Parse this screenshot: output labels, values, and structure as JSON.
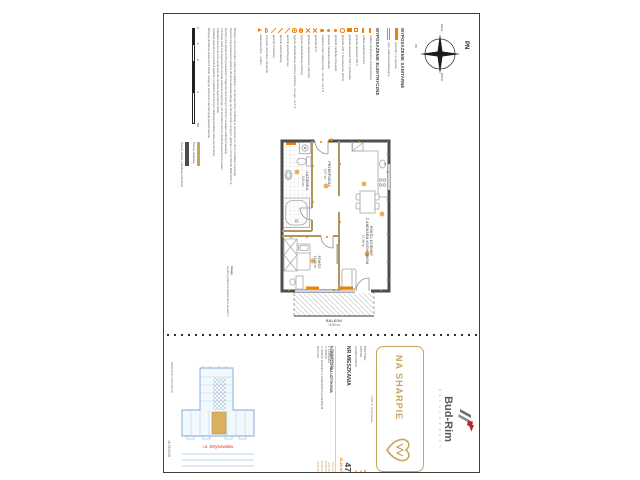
{
  "meta": {
    "date": "16.09.2025",
    "website": "www.bud-rim.com.pl"
  },
  "colors": {
    "accent_orange": "#EE8109",
    "wall_dark": "#4D4D4D",
    "wall_partition_gold": "#B2955C",
    "keyplan_blue": "#7DA7D9",
    "logo_gold": "#C9A45C",
    "brand_red": "#C02428",
    "street_red": "#D03020"
  },
  "compass": {
    "n": "PN",
    "s": "PD",
    "e": "WSCH",
    "w": "ZACH"
  },
  "brand": {
    "name": "Bud-Rim",
    "tagline": "D E V E L O P M E N T"
  },
  "investment": {
    "logo_text": "NA SHARPIE",
    "address": "Łódź ul. Strykowska"
  },
  "keyplan": {
    "street": "ul. Strykowska"
  },
  "scalebar": {
    "t0": "0",
    "t1": "1",
    "t2": "2",
    "t4": "4",
    "t6": "6m"
  },
  "walls_legend": {
    "partition": "Ściany działowe",
    "bearing": "Ściany nośne i obudowy kominów"
  },
  "sanitary": {
    "title": "WYPOSAŻENIE SANITARNE",
    "items": [
      {
        "icon": "radiator-bar",
        "label": "grzejnik c.o. płytowy"
      },
      {
        "icon": "riser-double-bar",
        "label": "pion wodno-kanalizacyjny"
      }
    ]
  },
  "electrical": {
    "title": "WYPOSAŻENIE ELEKTRYCZNE",
    "items": [
      {
        "icon": "bar",
        "label": "tablica elektryczna mieszkaniowa"
      },
      {
        "icon": "bar",
        "label": "tablica teletechniczna"
      },
      {
        "icon": "square",
        "label": "gniazdo wtykowe 230 V"
      },
      {
        "icon": "square-filled",
        "label": "gniazdo wtykowe 230 V podwójne"
      },
      {
        "icon": "ring",
        "label": "gniazdo 230 V hermetyczne (IP44)"
      },
      {
        "icon": "dot",
        "label": "gniazdo zasilania zmywarki"
      },
      {
        "icon": "dot",
        "label": "gniazdo zasilania lodówki"
      },
      {
        "icon": "dot",
        "label": "zasilanie płyty elektrycznej - we wn. +0,4 m"
      },
      {
        "icon": "x",
        "label": "gniazdo RTV"
      },
      {
        "icon": "x",
        "label": "gniazdo teletechniczne (internet)"
      },
      {
        "icon": "lamp",
        "label": "wypust oświetleniowy sufitowy"
      },
      {
        "icon": "lamp",
        "label": "wypust oświetleniowy ścienny (kinkiet) - na wys. +2,1 m"
      },
      {
        "icon": "switch",
        "label": "łącznik jednobiegunowy"
      },
      {
        "icon": "switch",
        "label": "łącznik świecznikowy"
      },
      {
        "icon": "switch",
        "label": "łącznik schodowy"
      },
      {
        "icon": "bell",
        "label": "przycisk dzwonka / dzwonek"
      },
      {
        "icon": "triangle",
        "label": "wideodomofon - unifon"
      }
    ]
  },
  "unit": {
    "number_label": "NR MIESZKANIA",
    "number": "47",
    "building_label": "BUDYNEK",
    "building": "B",
    "floor_label": "PIĘTRO",
    "floor": "2",
    "rooms_label": "LICZBA POKOI",
    "rooms_count": "2",
    "area_label": "POWIERZCHNIA UŻYTKOWA",
    "area": "51,26 m²",
    "room_rows": [
      {
        "no": "1.",
        "name": "PRZEDPOKÓJ",
        "area": "5,97 m²"
      },
      {
        "no": "2.",
        "name": "ŁAZIENKA",
        "area": "3,95 m²"
      },
      {
        "no": "3.",
        "name": "POKÓJ",
        "area": "13,96 m²"
      },
      {
        "no": "4.",
        "name": "POKÓJ DZIENNY Z ANEKSEM KUCHENNYM",
        "area": "27,38 m²"
      },
      {
        "no": "",
        "name": "BALKON",
        "area": "~6,50 m²"
      }
    ]
  },
  "plan_labels": {
    "hall": {
      "name": "PRZEDPOKÓJ",
      "area": "5,97 m²"
    },
    "bath": {
      "name": "ŁAZIENKA",
      "area": "3,95 m²"
    },
    "bedroom": {
      "name": "POKÓJ",
      "area": "13,96 m²"
    },
    "living": {
      "name": "POKÓJ DZIENNY",
      "name2": "Z ANEKSEM KUCHENNYM",
      "area": "27,38 m²"
    },
    "balcony": {
      "name": "BALKON",
      "area": "~6,50 m²"
    }
  },
  "disclaimer": {
    "l1": "Niniejszy rzut ma charakter wyłącznie poglądowy i nie stanowi oferty handlowej w rozumieniu art. 66 § 1 Kodeksu Cywilnego.",
    "l2": "Powierzchnie pomieszczeń podano dla stanu deweloperskiego, po obrysie ścian surowych, zgodnie z normą PN-ISO 9836:2015-12.",
    "l3": "Wymiary oraz powierzchnie pomieszczeń mogą ulec nieznacznym zmianom na etapie realizacji inwestycji.",
    "l4": "Aranżacja mebli oraz wyposażenia stanowi wyłącznie propozycję i nie wchodzi w zakres standardu wykończenia lokalu.",
    "l5": "Zabudowa kuchenna oraz sprzęt AGD nie stanowią wyposażenia lokalu.",
    "l6": "Instalacje wewnętrzne wykonano zgodnie z projektem technicznym; lokalizacja punktów może ulec korekcie.",
    "l7": "Wiążące określenie powierzchni lokalu nastąpi po wykonaniu inwentaryzacji powykonawczej.",
    "note1": "Uwaga:",
    "note2": "wymiary podano w świetle ścian surowych"
  }
}
